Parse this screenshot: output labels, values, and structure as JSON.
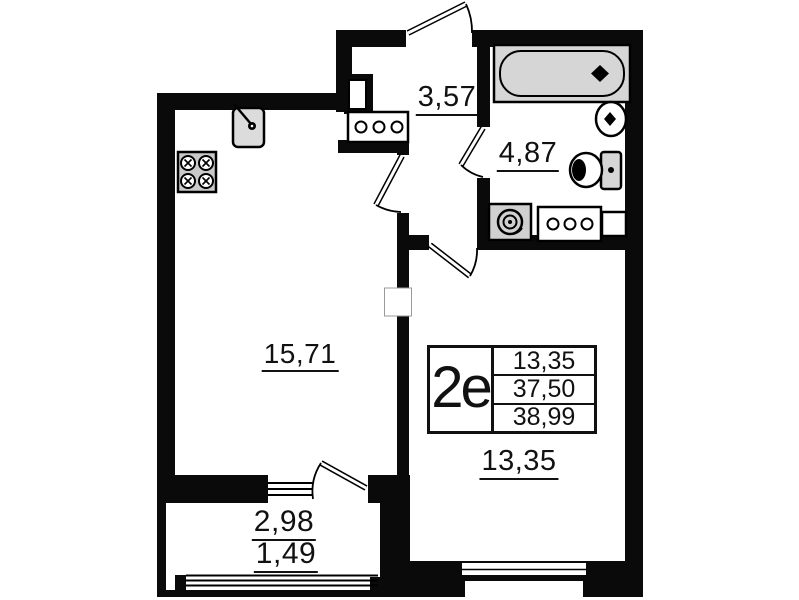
{
  "rooms": {
    "kitchen_living": {
      "area": "15,71"
    },
    "hallway": {
      "area": "3,57"
    },
    "bathroom": {
      "area": "4,87"
    },
    "bedroom": {
      "area": "13,35"
    },
    "balcony": {
      "area_full": "2,98",
      "area_reduced": "1,49"
    }
  },
  "stamp": {
    "unit_type": "2е",
    "rows": [
      "13,35",
      "37,50",
      "38,99"
    ]
  },
  "fixture_icons": [
    "bathtub-icon",
    "washbasin-icon",
    "toilet-icon",
    "washing-machine-icon",
    "vent-block-icon",
    "kitchen-sink-icon",
    "stove-icon",
    "door-swing-icon",
    "window-icon"
  ],
  "colors": {
    "wall": "#0a0a0a",
    "fixture_fill": "#d6d6d6",
    "text": "#111111",
    "background": "#ffffff"
  }
}
